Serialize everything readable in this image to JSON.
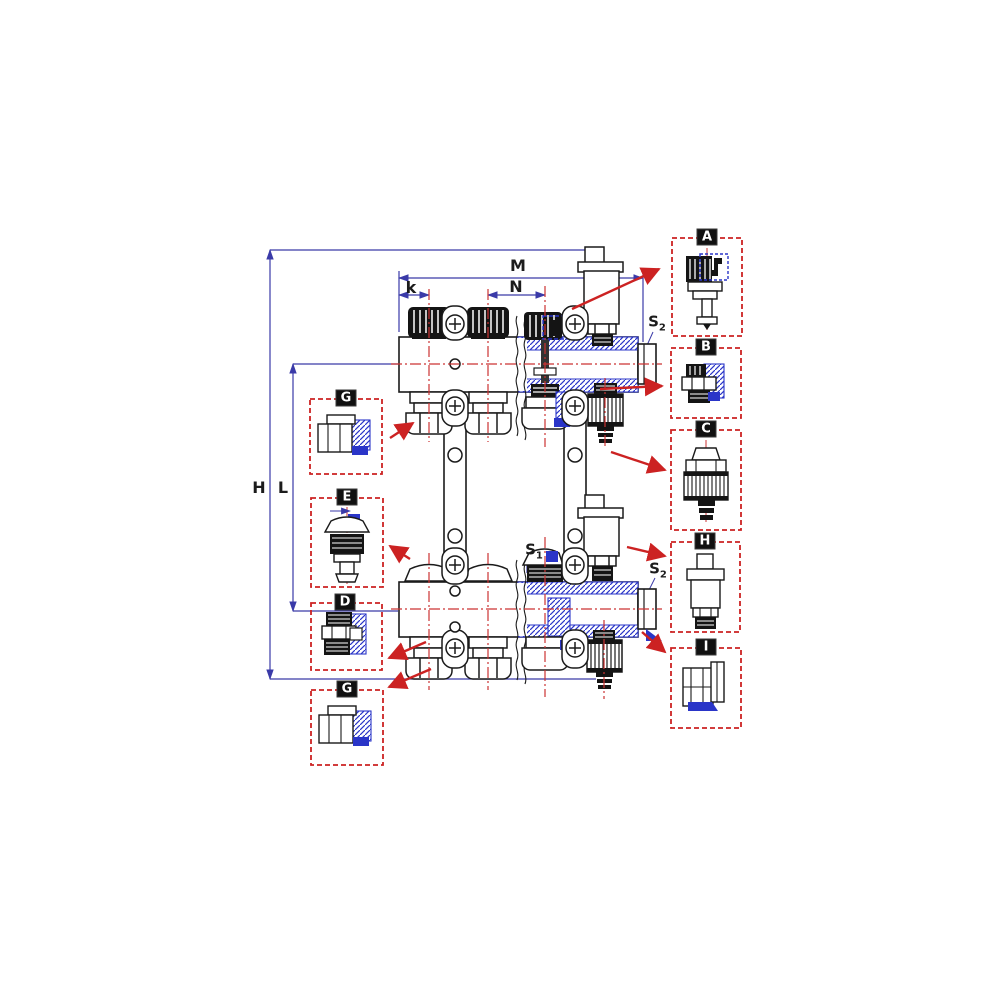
{
  "meta": {
    "description": "Technical assembly drawing of a floor-heating distribution manifold (supply and return bars) with lettered detail callouts and dimension lines"
  },
  "colors": {
    "background": "#ffffff",
    "line": "#1a1a1a",
    "dimension_blue": "#3a3aa8",
    "centerline_red": "#cc3333",
    "callout_red": "#cc2222",
    "section_blue": "#2a35c8",
    "badge_bg": "#111111",
    "badge_text": "#ffffff"
  },
  "dimensions": {
    "m": "M",
    "n": "N",
    "k": "k",
    "h": "H",
    "l": "L",
    "s1": {
      "base": "S",
      "sub": "1"
    },
    "s2_top": {
      "base": "S",
      "sub": "2"
    },
    "s2_bottom": {
      "base": "S",
      "sub": "2"
    }
  },
  "callouts": {
    "right": [
      {
        "label": "A",
        "part": "thermostatic-valve-insert"
      },
      {
        "label": "B",
        "part": "drain-port-fitting"
      },
      {
        "label": "C",
        "part": "fill-drain-valve-with-hose-barb"
      },
      {
        "label": "H",
        "part": "automatic-air-vent"
      },
      {
        "label": "I",
        "part": "manifold-end-plug"
      }
    ],
    "left": [
      {
        "label": "G",
        "part": "compression-pipe-fitting"
      },
      {
        "label": "E",
        "part": "manual-valve-insert"
      },
      {
        "label": "D",
        "part": "reducing-adapter"
      },
      {
        "label": "G",
        "part": "compression-pipe-fitting"
      }
    ]
  }
}
